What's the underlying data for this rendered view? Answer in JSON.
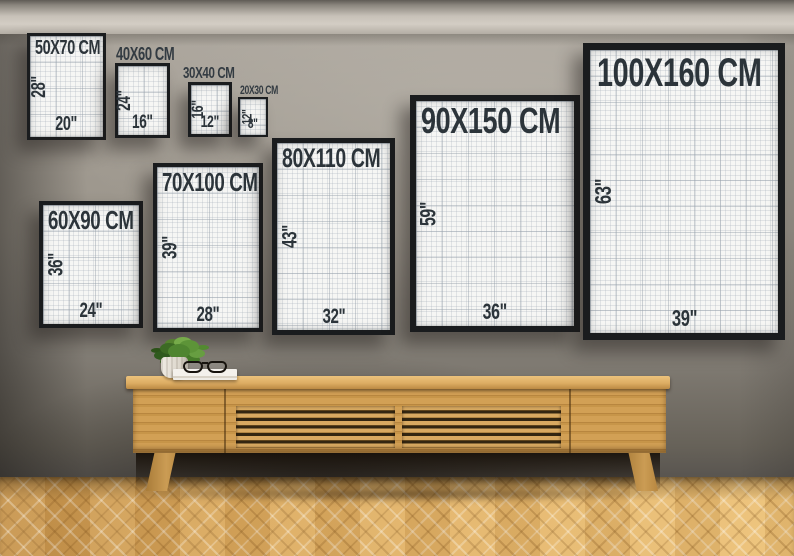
{
  "scene": {
    "description": "Poster frame size comparison guide on a wall above a wooden slatted sideboard",
    "wall_color": "#8d8880",
    "ceiling_color": "#cbc5bc",
    "floor_color": "#dcab63",
    "wood_color": "#cf9d52",
    "frame_color": "#1a1c1e",
    "paper_color": "#f6f6f4",
    "grid_line_color": "#ccd3d8",
    "text_color": "#2c343a"
  },
  "frames": [
    {
      "label": "50X70 CM",
      "height_in": "28\"",
      "width_in": "20\"",
      "label_placement": "inside"
    },
    {
      "label": "40X60 CM",
      "height_in": "24\"",
      "width_in": "16\"",
      "label_placement": "above"
    },
    {
      "label": "30X40 CM",
      "height_in": "16\"",
      "width_in": "12\"",
      "label_placement": "above"
    },
    {
      "label": "20X30 CM",
      "height_in": "12\"",
      "width_in": "8\"",
      "label_placement": "above"
    },
    {
      "label": "60X90 CM",
      "height_in": "36\"",
      "width_in": "24\"",
      "label_placement": "inside"
    },
    {
      "label": "70X100 CM",
      "height_in": "39\"",
      "width_in": "28\"",
      "label_placement": "inside"
    },
    {
      "label": "80X110 CM",
      "height_in": "43\"",
      "width_in": "32\"",
      "label_placement": "inside"
    },
    {
      "label": "90X150 CM",
      "height_in": "59\"",
      "width_in": "36\"",
      "label_placement": "inside"
    },
    {
      "label": "100X160 CM",
      "height_in": "63\"",
      "width_in": "39\"",
      "label_placement": "inside"
    }
  ]
}
